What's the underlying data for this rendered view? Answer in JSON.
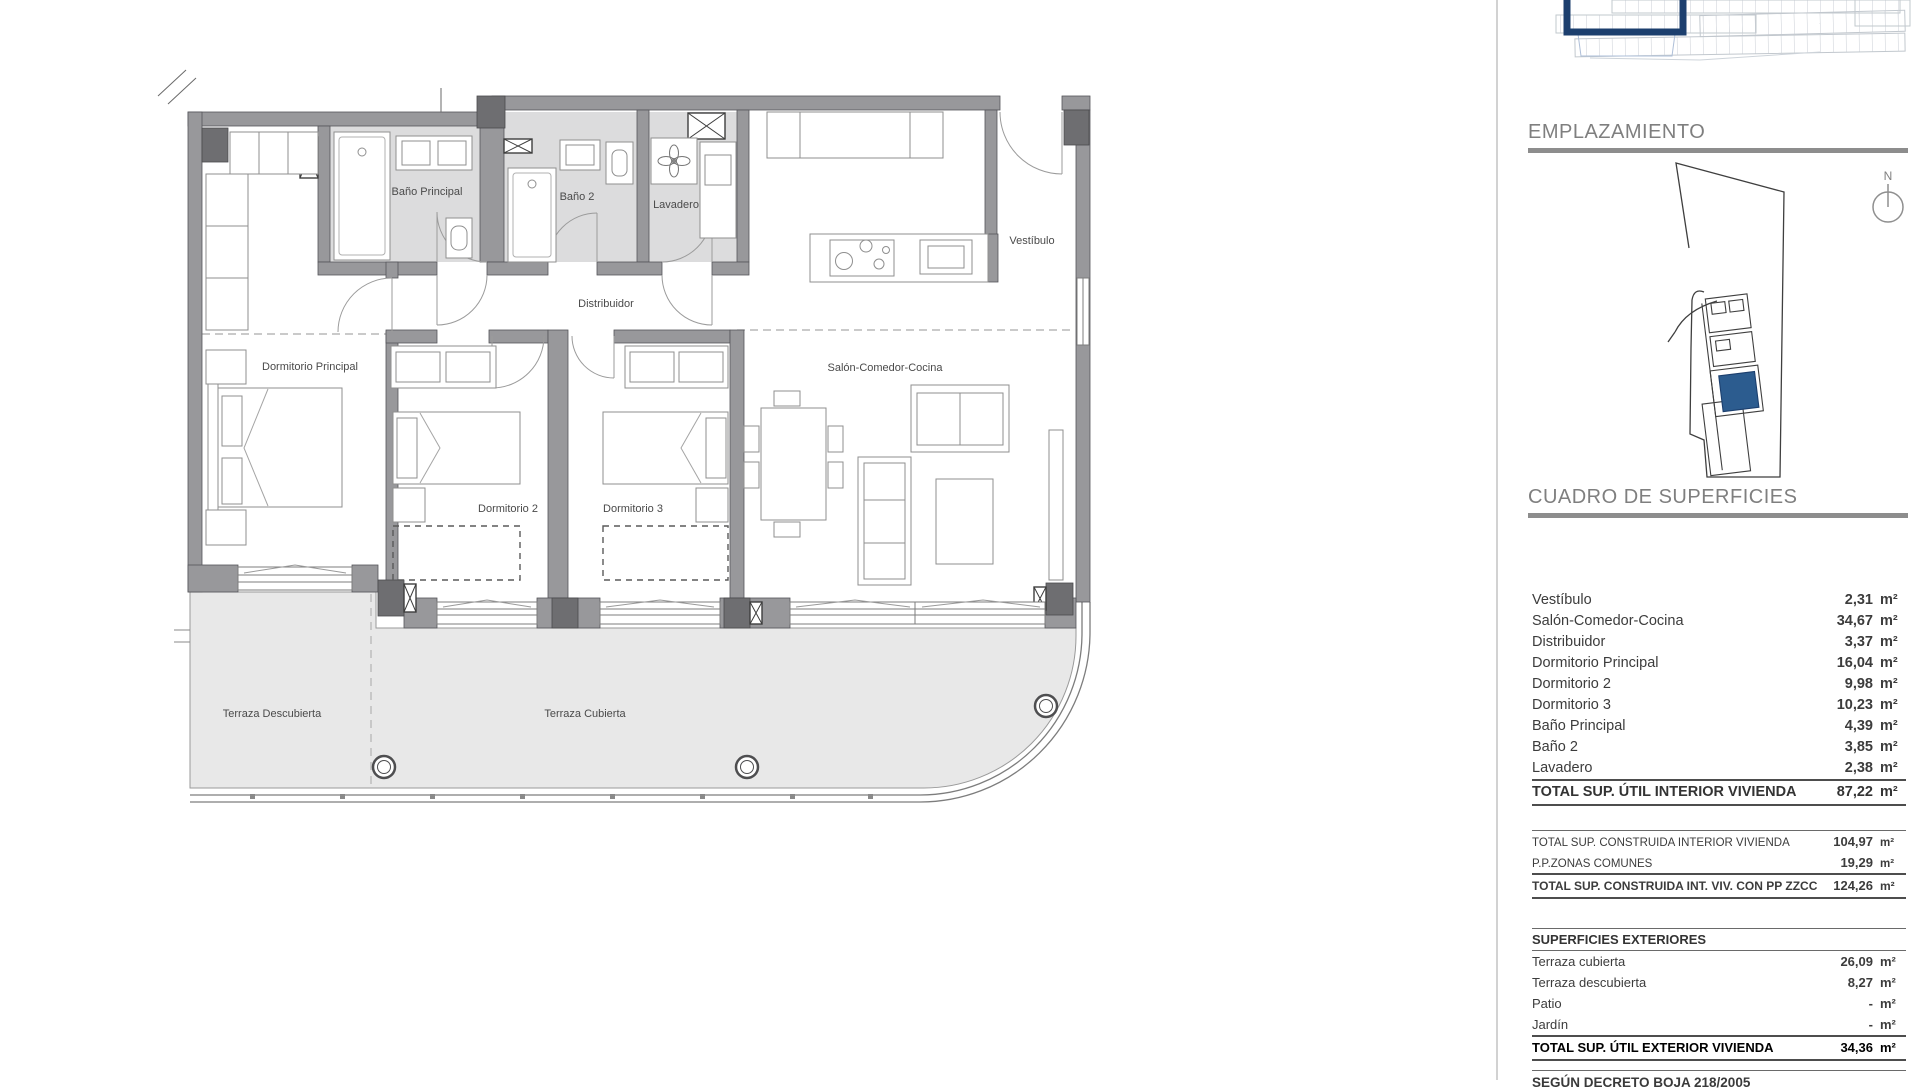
{
  "plan": {
    "labels": {
      "bano_principal": "Baño Principal",
      "bano_2": "Baño 2",
      "lavadero": "Lavadero",
      "vestibulo": "Vestíbulo",
      "distribuidor": "Distribuidor",
      "dormitorio_principal": "Dormitorio Principal",
      "dormitorio_2": "Dormitorio 2",
      "dormitorio_3": "Dormitorio 3",
      "salon": "Salón-Comedor-Cocina",
      "terraza_descubierta": "Terraza Descubierta",
      "terraza_cubierta": "Terraza Cubierta"
    }
  },
  "sidebar": {
    "emplazamiento_title": "EMPLAZAMIENTO",
    "north_label": "N",
    "cuadro_title": "CUADRO DE SUPERFICIES",
    "interior_rows": [
      {
        "label": "Vestíbulo",
        "value": "2,31",
        "unit": "m²"
      },
      {
        "label": "Salón-Comedor-Cocina",
        "value": "34,67",
        "unit": "m²"
      },
      {
        "label": "Distribuidor",
        "value": "3,37",
        "unit": "m²"
      },
      {
        "label": "Dormitorio Principal",
        "value": "16,04",
        "unit": "m²"
      },
      {
        "label": "Dormitorio 2",
        "value": "9,98",
        "unit": "m²"
      },
      {
        "label": "Dormitorio 3",
        "value": "10,23",
        "unit": "m²"
      },
      {
        "label": "Baño Principal",
        "value": "4,39",
        "unit": "m²"
      },
      {
        "label": "Baño 2",
        "value": "3,85",
        "unit": "m²"
      },
      {
        "label": "Lavadero",
        "value": "2,38",
        "unit": "m²"
      }
    ],
    "interior_total": {
      "label": "TOTAL SUP. ÚTIL INTERIOR VIVIENDA",
      "value": "87,22",
      "unit": "m²"
    },
    "construida_rows": [
      {
        "label": "TOTAL SUP. CONSTRUIDA INTERIOR VIVIENDA",
        "value": "104,97",
        "unit": "m²"
      },
      {
        "label": "P.P.ZONAS COMUNES",
        "value": "19,29",
        "unit": "m²"
      }
    ],
    "construida_total": {
      "label": "TOTAL SUP. CONSTRUIDA INT. VIV. CON PP ZZCC",
      "value": "124,26",
      "unit": "m²"
    },
    "exteriores_title": "SUPERFICIES EXTERIORES",
    "exterior_rows": [
      {
        "label": "Terraza cubierta",
        "value": "26,09",
        "unit": "m²"
      },
      {
        "label": "Terraza descubierta",
        "value": "8,27",
        "unit": "m²"
      },
      {
        "label": "Patio",
        "value": "-",
        "unit": "m²"
      },
      {
        "label": "Jardín",
        "value": "-",
        "unit": "m²"
      }
    ],
    "exterior_total": {
      "label": "TOTAL SUP. ÚTIL EXTERIOR VIVIENDA",
      "value": "34,36",
      "unit": "m²"
    },
    "footer_note": "SEGÚN DECRETO BOJA 218/2005"
  },
  "colors": {
    "highlight_blue": "#2c5c8f",
    "outline_blue": "#1c3f6e",
    "wall_gray": "#98989b",
    "pillar_gray": "#6e6e71",
    "bath_floor": "#dcdcdd",
    "terrace_floor": "#e8e8e8",
    "heading_bar": "#8d8d8d"
  }
}
